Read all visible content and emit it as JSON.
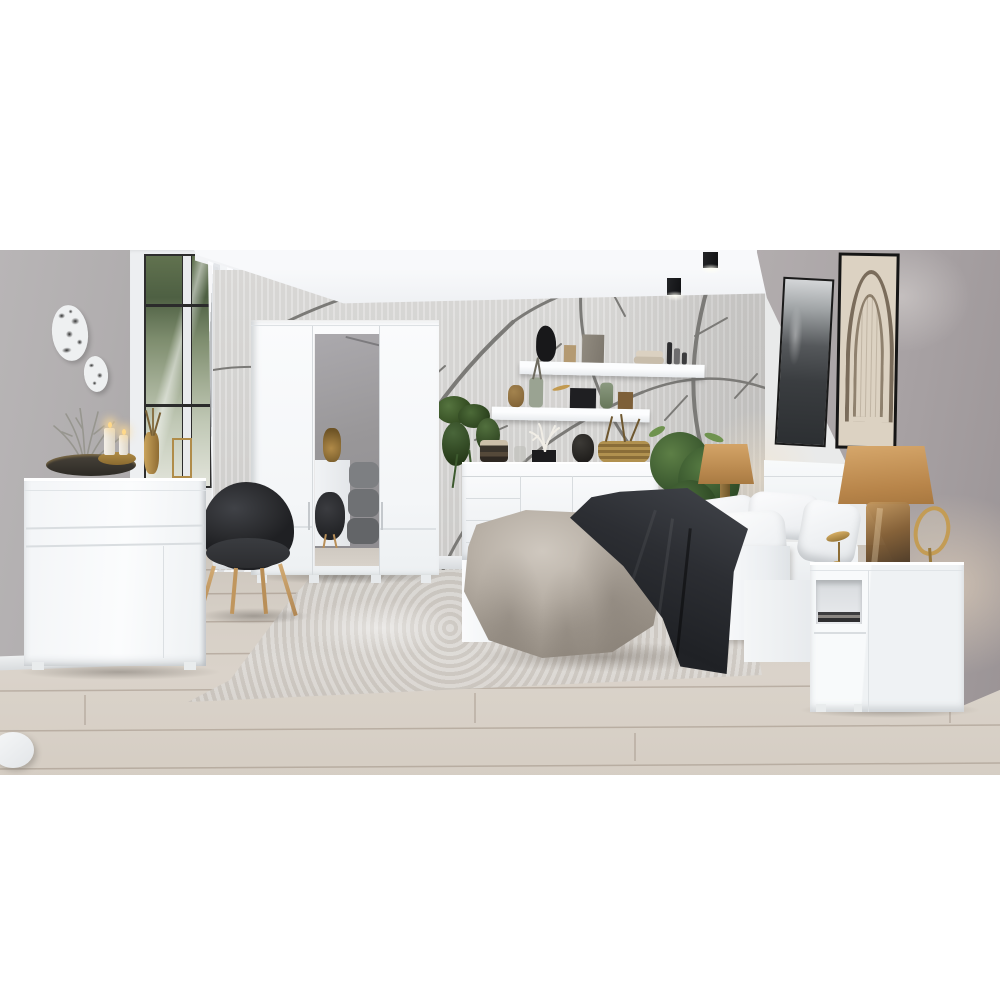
{
  "scene": {
    "title": "Modern bedroom with glossy white furniture set, grey walls and branch-pattern wallpaper",
    "room": "bedroom",
    "style": "scandinavian modern showroom photograph",
    "time_of_day": "daytime"
  },
  "frame": {
    "background": "#ffffff",
    "photo_top_px": 250,
    "photo_height_px": 525
  },
  "palette": {
    "ceiling": "#f4f6f8",
    "left_wall": "#b3b0b1",
    "right_wall": "#a7a1a3",
    "wallpaper_base": "#d4d3d1",
    "wallpaper_branches": "#7a7976",
    "furniture_white": "#f6f8f9",
    "floor_wood": "#d4cdc4",
    "rug": "#d3cfca",
    "chair_fabric": "#2c2d30",
    "wood_legs": "#c49b63",
    "duvet": "#ada49a",
    "throw_blanket": "#2e3034",
    "pillows": "#f3f4f6",
    "lamp_shades": "#c59a5e",
    "amber_glass": "#8a5f33",
    "gold_accents": "#b9914f",
    "plant_green": "#41603a",
    "window_foliage": "#5a6b4a"
  },
  "objects": {
    "wall_plates": {
      "label": "Two decorative white plates with black abstract pattern",
      "count": 2
    },
    "window": {
      "label": "White french window with black muntin grid and garden view"
    },
    "curtain": {
      "label": "Sheer white curtain beside window"
    },
    "wardrobe": {
      "label": "Three-door white wardrobe with central mirror door",
      "doors": 3,
      "mirror_doors": 1
    },
    "dresser": {
      "label": "White gloss chest of drawers",
      "decor": [
        "silver coral branch",
        "dark oval tray",
        "two lit pillar candles in gold bowl",
        "gold vase with dried stems",
        "gold wire stand"
      ]
    },
    "chair": {
      "label": "Black round tub chair with oak legs"
    },
    "wall_shelves": {
      "label": "Two white floating wall shelves",
      "count": 2,
      "upper_items": [
        "black bust sculpture",
        "small tan box",
        "grey box",
        "folded beige towels",
        "cosmetic bottles"
      ],
      "lower_items": [
        "hanging green plant",
        "brown jar",
        "grey-green vase with twigs",
        "gold leaf ornament",
        "black box",
        "green glass vase",
        "brown box"
      ]
    },
    "sideboard": {
      "label": "White sideboard behind bed foot",
      "decor": [
        "stacked dark candles",
        "glass jar",
        "white coral in black pot",
        "black stone vase",
        "wicker basket with dried twigs"
      ]
    },
    "bed": {
      "label": "White double bed",
      "bedding": [
        "white pillows",
        "greige duvet draped over foot",
        "dark graphite throw"
      ]
    },
    "headboard": {
      "label": "White panel headboard"
    },
    "plant": {
      "label": "Large green potted plant beside bed"
    },
    "bedside_lamps": {
      "label": "Two table lamps with camel shades and amber glass bases",
      "count": 2
    },
    "nightstand": {
      "label": "White nightstand with open magazine shelf and drawer",
      "decor": [
        "table lamp",
        "gold bird figurine",
        "gold vanity mirror"
      ]
    },
    "pictures": {
      "label": "Two tall framed artworks on right wall",
      "count": 2,
      "descriptions": [
        "black and white landscape photograph",
        "sepia architectural arch sketch"
      ]
    },
    "ceiling_spotlights": {
      "label": "Two black cube ceiling spotlights",
      "count": 2
    },
    "wallpaper": {
      "label": "Grey branch-silhouette wallpaper on back wall"
    },
    "rug": {
      "label": "Distressed light grey area rug"
    },
    "floor": {
      "label": "Light oak plank flooring"
    },
    "pouf": {
      "label": "White pouf cropped at bottom-left corner"
    }
  }
}
